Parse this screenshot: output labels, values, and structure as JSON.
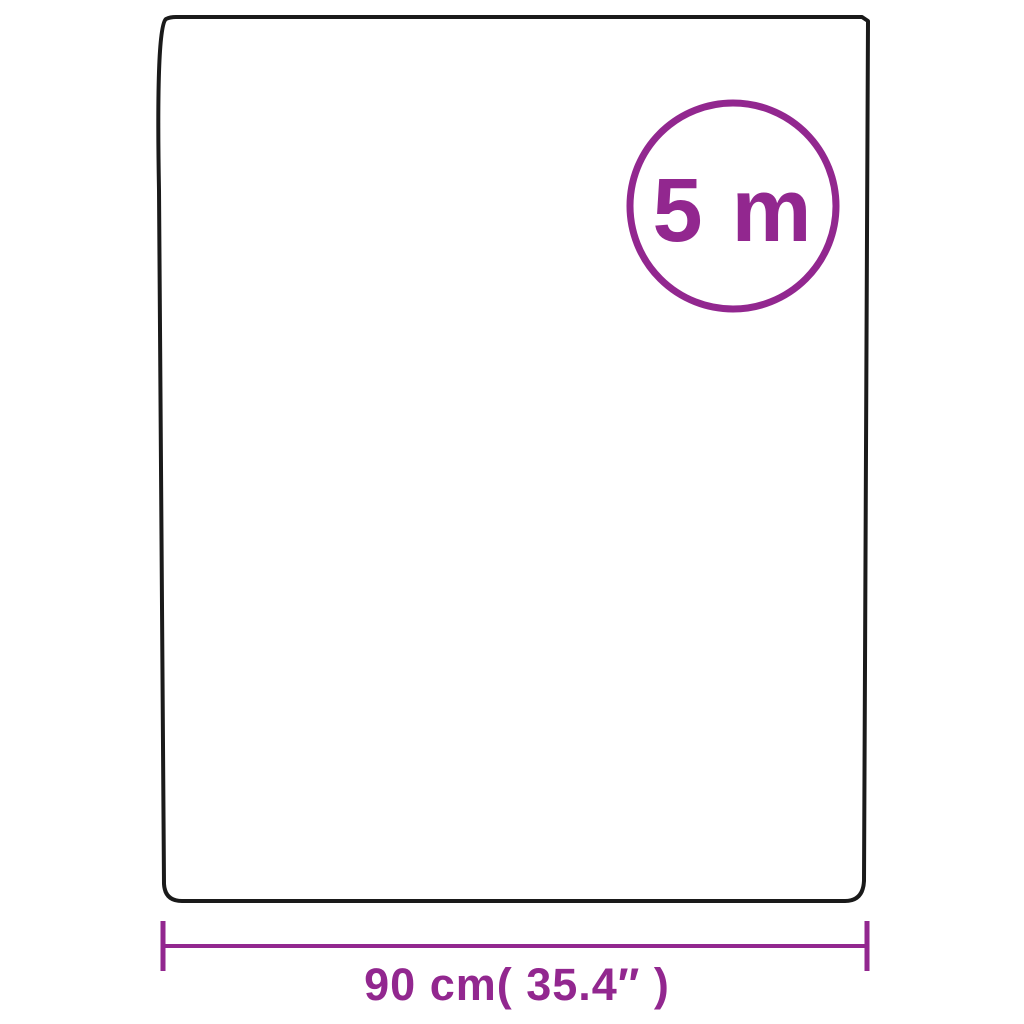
{
  "diagram": {
    "badge": {
      "text": "5 m"
    },
    "dimension": {
      "text": "90 cm( 35.4″ )"
    },
    "colors": {
      "accent": "#92278F",
      "outline": "#1A1A1A",
      "background": "#FFFFFF"
    }
  }
}
